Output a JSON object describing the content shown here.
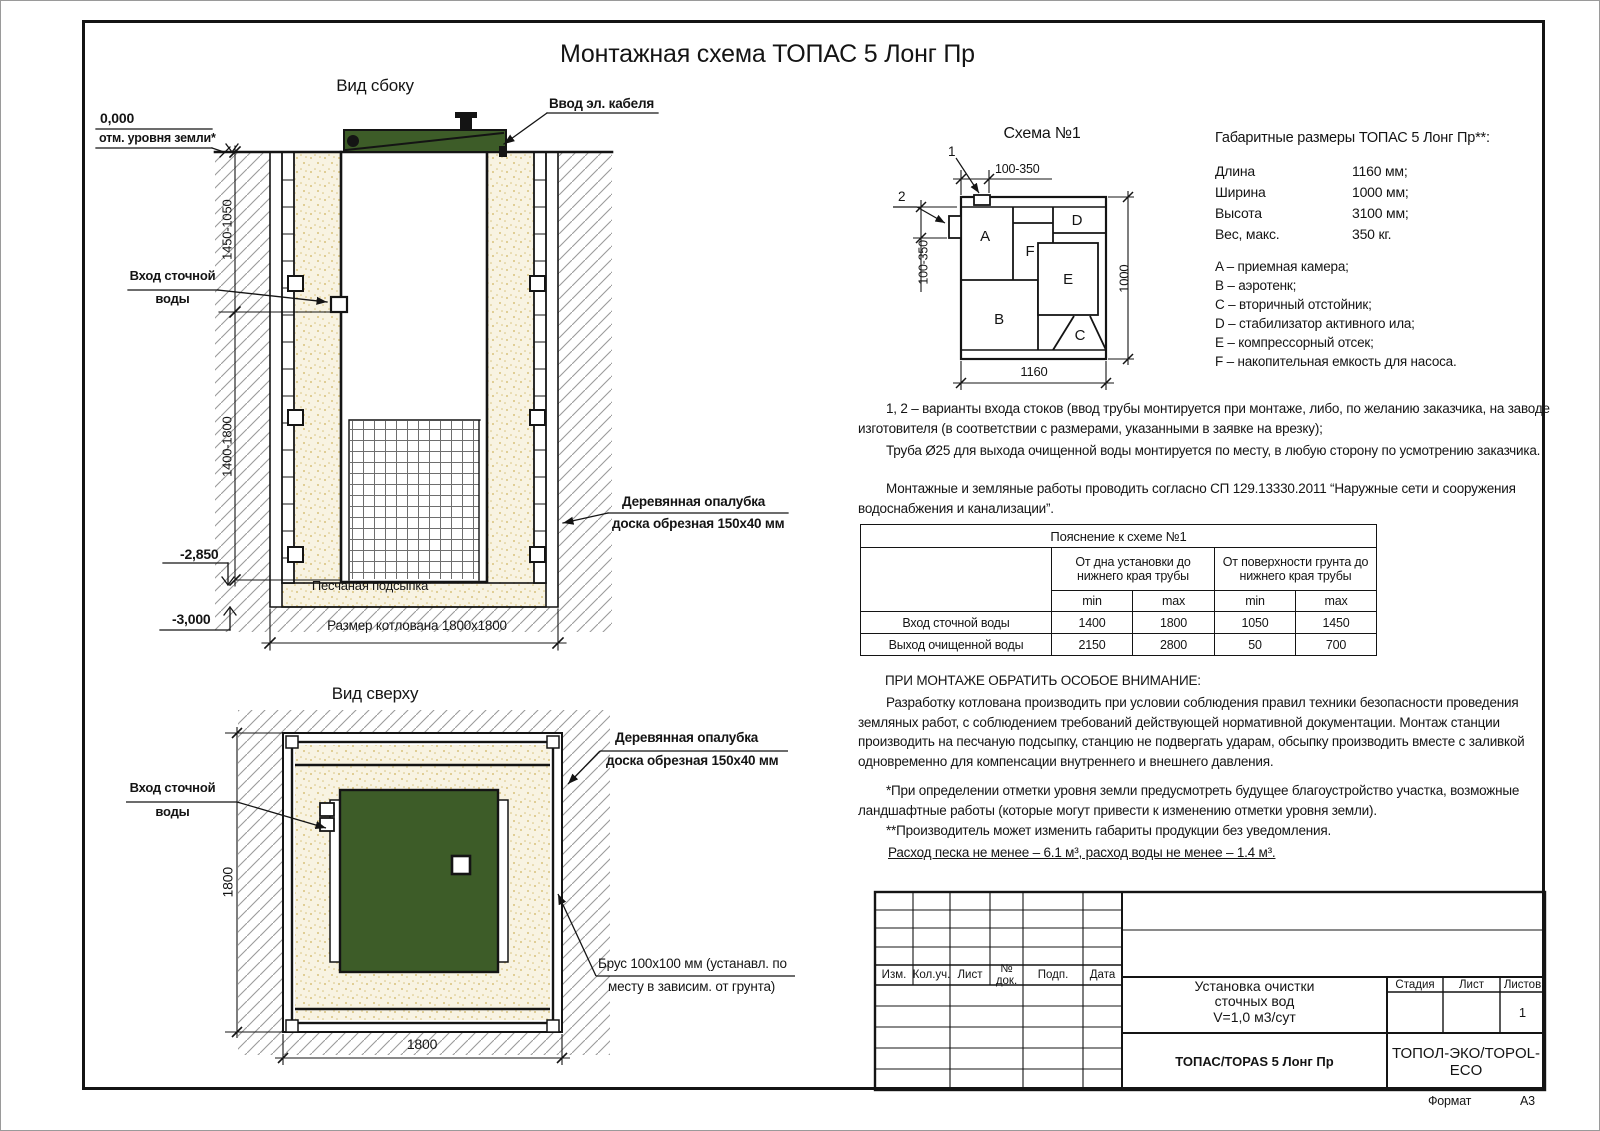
{
  "page": {
    "title": "Монтажная схема ТОПАС 5 Лонг Пр",
    "format_label": "Формат",
    "format_value": "А3"
  },
  "colors": {
    "green": "#3d5c28",
    "sand_bg": "#f8f3e2",
    "hatch": "#9a9a9a"
  },
  "side_view": {
    "title": "Вид сбоку",
    "zero_mark": "0,000",
    "ground_label": "отм. уровня земли*",
    "cable_label": "Ввод эл. кабеля",
    "inlet_line1": "Вход сточной",
    "inlet_line2": "воды",
    "dim_upper": "1450-1050",
    "dim_lower": "1400-1800",
    "formwork_line1": "Деревянная опалубка",
    "formwork_line2": "доска обрезная 150x40 мм",
    "mark_minus_2850": "-2,850",
    "mark_minus_3000": "-3,000",
    "sand_label": "Песчаная подсыпка",
    "pit_dim": "Размер котлована 1800x1800"
  },
  "top_view": {
    "title": "Вид сверху",
    "inlet_line1": "Вход сточной",
    "inlet_line2": "воды",
    "formwork_line1": "Деревянная опалубка",
    "formwork_line2": "доска обрезная 150x40 мм",
    "beam_line1": "Брус 100x100 мм (устанавл. по",
    "beam_line2": "месту в зависим. от грунта)",
    "dim_left": "1800",
    "dim_bottom": "1800"
  },
  "schema": {
    "title": "Схема №1",
    "callout_1": "1",
    "callout_2": "2",
    "dim_top": "100-350",
    "dim_left": "100-350",
    "dim_bottom": "1160",
    "dim_right": "1000",
    "compartments": {
      "a": "A",
      "b": "B",
      "c": "C",
      "d": "D",
      "e": "E",
      "f": "F"
    }
  },
  "specs": {
    "title": "Габаритные размеры ТОПАС 5 Лонг Пр**:",
    "rows": [
      {
        "label": "Длина",
        "value": "1160 мм;"
      },
      {
        "label": "Ширина",
        "value": "1000 мм;"
      },
      {
        "label": "Высота",
        "value": "3100 мм;"
      },
      {
        "label": "Вес, макс.",
        "value": "350 кг."
      }
    ],
    "legend": [
      "A – приемная камера;",
      "B – аэротенк;",
      "C – вторичный отстойник;",
      "D – стабилизатор активного ила;",
      "E – компрессорный отсек;",
      "F – накопительная емкость для насоса."
    ]
  },
  "notes": {
    "p1": "1, 2 – варианты входа  стоков (ввод трубы монтируется при монтаже, либо, по желанию заказчика, на заводе изготовителя (в соответствии с размерами, указанными в заявке на врезку);",
    "p2": "Труба Ø25 для выхода очищенной воды монтируется по месту, в любую сторону по усмотрению заказчика.",
    "p3": "Монтажные и земляные работы проводить согласно СП 129.13330.2011 “Наружные сети и сооружения водоснабжения и канализации”."
  },
  "table": {
    "title": "Пояснение к схеме №1",
    "group1": "От дна установки до нижнего края трубы",
    "group2": "От поверхности грунта до нижнего края трубы",
    "min_label": "min",
    "max_label": "max",
    "rows": [
      {
        "label": "Вход сточной воды",
        "v1": "1400",
        "v2": "1800",
        "v3": "1050",
        "v4": "1450"
      },
      {
        "label": "Выход очищенной воды",
        "v1": "2150",
        "v2": "2800",
        "v3": "50",
        "v4": "700"
      }
    ]
  },
  "attention": {
    "title": "ПРИ МОНТАЖЕ ОБРАТИТЬ ОСОБОЕ ВНИМАНИЕ:",
    "body": "Разработку котлована производить при условии соблюдения правил техники безопасности проведения земляных работ, с соблюдением требований действующей нормативной документации. Монтаж станции производить на песчаную подсыпку, станцию не подвергать ударам, обсыпку производить вместе с заливкой одновременно для компенсации внутреннего и внешнего давления."
  },
  "footnotes": {
    "f1": "*При определении отметки уровня земли предусмотреть будущее благоустройство участка, возможные ландшафтные работы (которые могут привести к изменению отметки уровня земли).",
    "f2": "**Производитель может изменить габариты продукции без уведомления."
  },
  "consumption": "Расход песка не менее – 6.1 м³, расход воды не менее – 1.4 м³.",
  "title_block": {
    "rev_headers": [
      "Изм.",
      "Кол.уч.",
      "Лист",
      "№ док.",
      "Подп.",
      "Дата"
    ],
    "doc_line1": "Установка очистки",
    "doc_line2": "сточных вод",
    "doc_line3": "V=1,0 м3/сут",
    "model": "ТОПАС/TOPAS 5 Лонг Пр",
    "company": "ТОПОЛ-ЭКО/TOPOL-ECO",
    "stage_label": "Стадия",
    "sheet_label": "Лист",
    "sheets_label": "Листов",
    "sheets_value": "1"
  }
}
